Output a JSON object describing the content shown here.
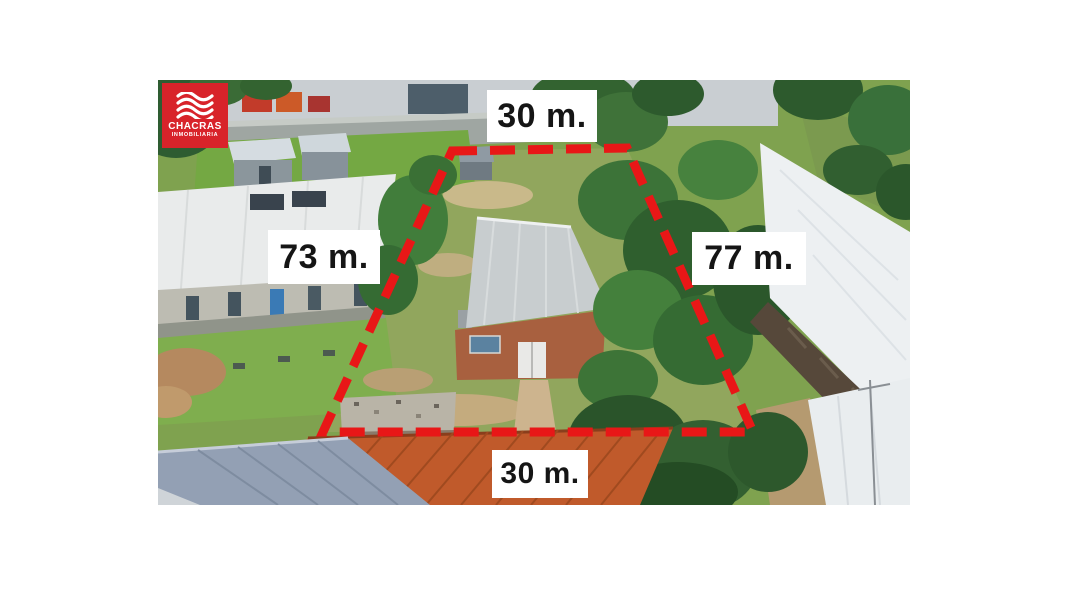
{
  "canvas": {
    "background": "#ffffff"
  },
  "logo": {
    "title": "CHACRAS",
    "subtitle": "INMOBILIARIA",
    "background_color": "#d8232a",
    "icon": "waves-icon"
  },
  "photo": {
    "description": "Aerial drone photo of a property lot outlined with a red dashed boundary, surrounded by industrial buildings, tile roofs and trees",
    "boundary_color": "#e81717",
    "boundary_style": "dashed"
  },
  "measurements": {
    "top": "30 m.",
    "left": "73 m.",
    "right": "77 m.",
    "bottom": "30 m.",
    "label_background": "#ffffff",
    "label_text_color": "#151515"
  }
}
